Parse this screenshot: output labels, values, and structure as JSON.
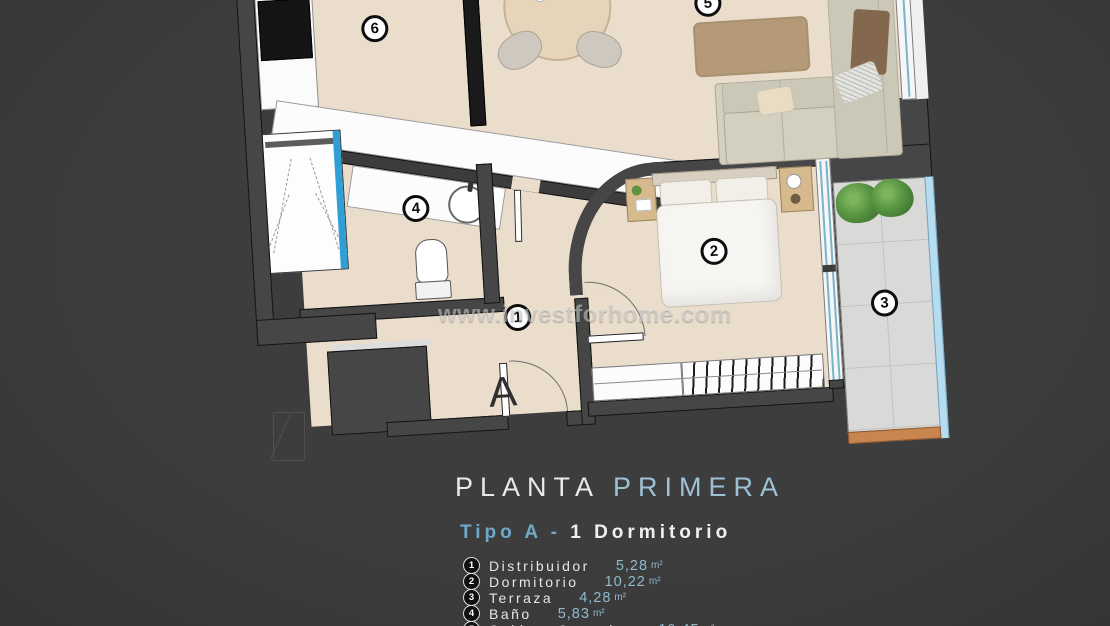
{
  "watermark": "www.investforhome.com",
  "title": {
    "main": "PLANTA ",
    "accent": "PRIMERA"
  },
  "subtitle": {
    "accent": "Tipo A - ",
    "main": "1 Dormitorio"
  },
  "entrance_label": "A",
  "markers": [
    "1",
    "2",
    "3",
    "4",
    "5",
    "6"
  ],
  "legend": [
    {
      "num": "1",
      "name": "Distribuidor",
      "area": "5,28",
      "unit": "m²"
    },
    {
      "num": "2",
      "name": "Dormitorio",
      "area": "10,22",
      "unit": "m²"
    },
    {
      "num": "3",
      "name": "Terraza",
      "area": "4,28",
      "unit": "m²"
    },
    {
      "num": "4",
      "name": "Baño",
      "area": "5,83",
      "unit": "m²"
    },
    {
      "num": "5",
      "name": "Salón - Comedor",
      "area": "10,45",
      "unit": "m²"
    }
  ],
  "colors": {
    "background": "#3d3d3d",
    "accent_blue": "#8fb9cd",
    "text": "#e8e8e8",
    "floor": "#eaddcb",
    "wall": "#464646",
    "terrace": "#d9d9d7",
    "glass": "#b5ddef",
    "shower_glass": "#2f9fd6",
    "rug": "#b49a77",
    "terrace_sill": "#c9854e"
  }
}
